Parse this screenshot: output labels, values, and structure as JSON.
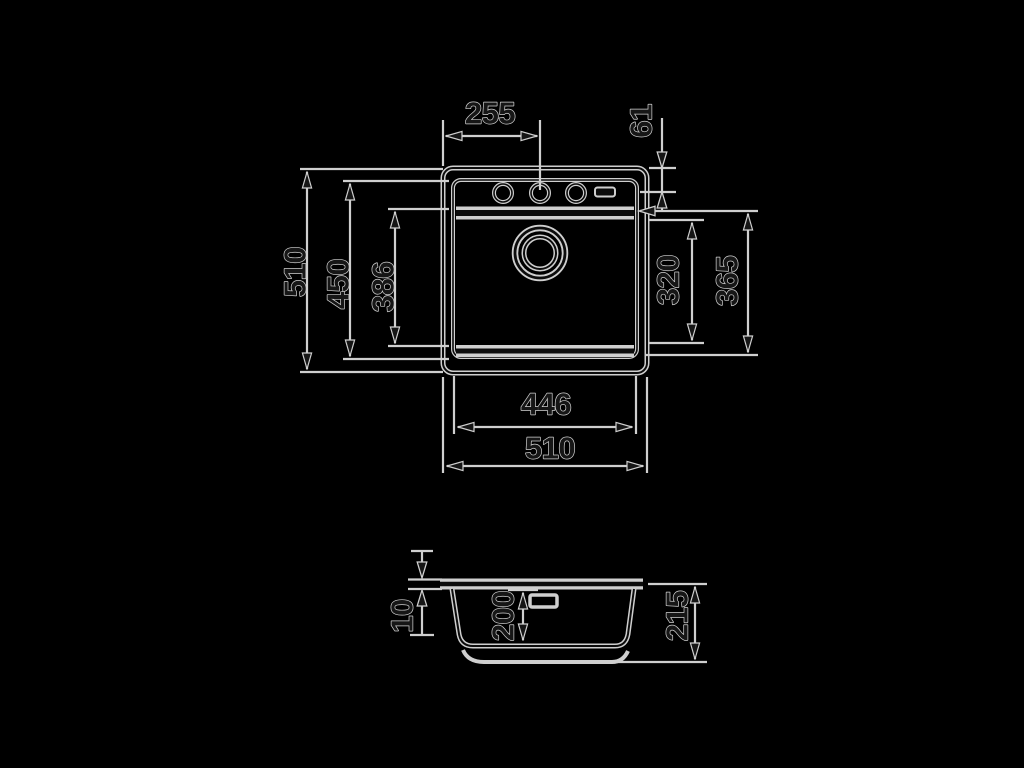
{
  "drawing": {
    "type": "sink-dimension-diagram",
    "colors": {
      "background": "#000000",
      "line": "#cfcfcf",
      "line_core": "#0c0c0c"
    },
    "top_view": {
      "dims": {
        "faucet_offset_from_left": "255",
        "faucet_offset_from_top": "61",
        "overall_length": "510",
        "rim_inner_length": "450",
        "bowl_length": "386",
        "bowl_inner_width": "320",
        "bowl_width": "365",
        "bowl_opening_width": "446",
        "overall_width": "510"
      }
    },
    "side_view": {
      "dims": {
        "rim_thickness": "10",
        "bowl_depth": "200",
        "overall_depth": "215"
      }
    }
  }
}
